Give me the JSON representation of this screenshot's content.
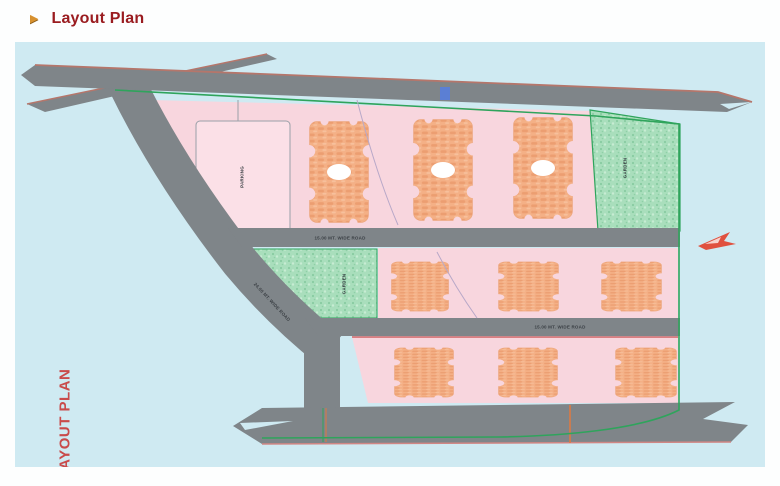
{
  "header": {
    "bullet_icon": "▶",
    "title": "Layout Plan"
  },
  "plan": {
    "watermark": "LAYOUT PLAN",
    "labels": {
      "parking": "PARKING",
      "garden_right": "GARDEN",
      "garden_left": "GARDEN",
      "road1": "15.00 MT. WIDE ROAD",
      "road2": "15.00 MT. WIDE ROAD",
      "road_diagonal": "24.00 MT. WIDE ROAD"
    },
    "colors": {
      "canvas_blue": "#cfeaf2",
      "road_gray": "#7f8589",
      "road_edge_brown": "#b5766b",
      "plot_pink": "#f8d6de",
      "parking_fill": "#fbe0e7",
      "building_orange": "#f4b086",
      "green_area": "#a9debc",
      "boundary_green": "#2fa45c",
      "watermark_red": "#c94b4b",
      "title_red": "#9a1c20",
      "bullet_gold": "#d7912f",
      "north_arrow_red": "#e0513f",
      "gate_blue": "#5b7fd4"
    }
  }
}
